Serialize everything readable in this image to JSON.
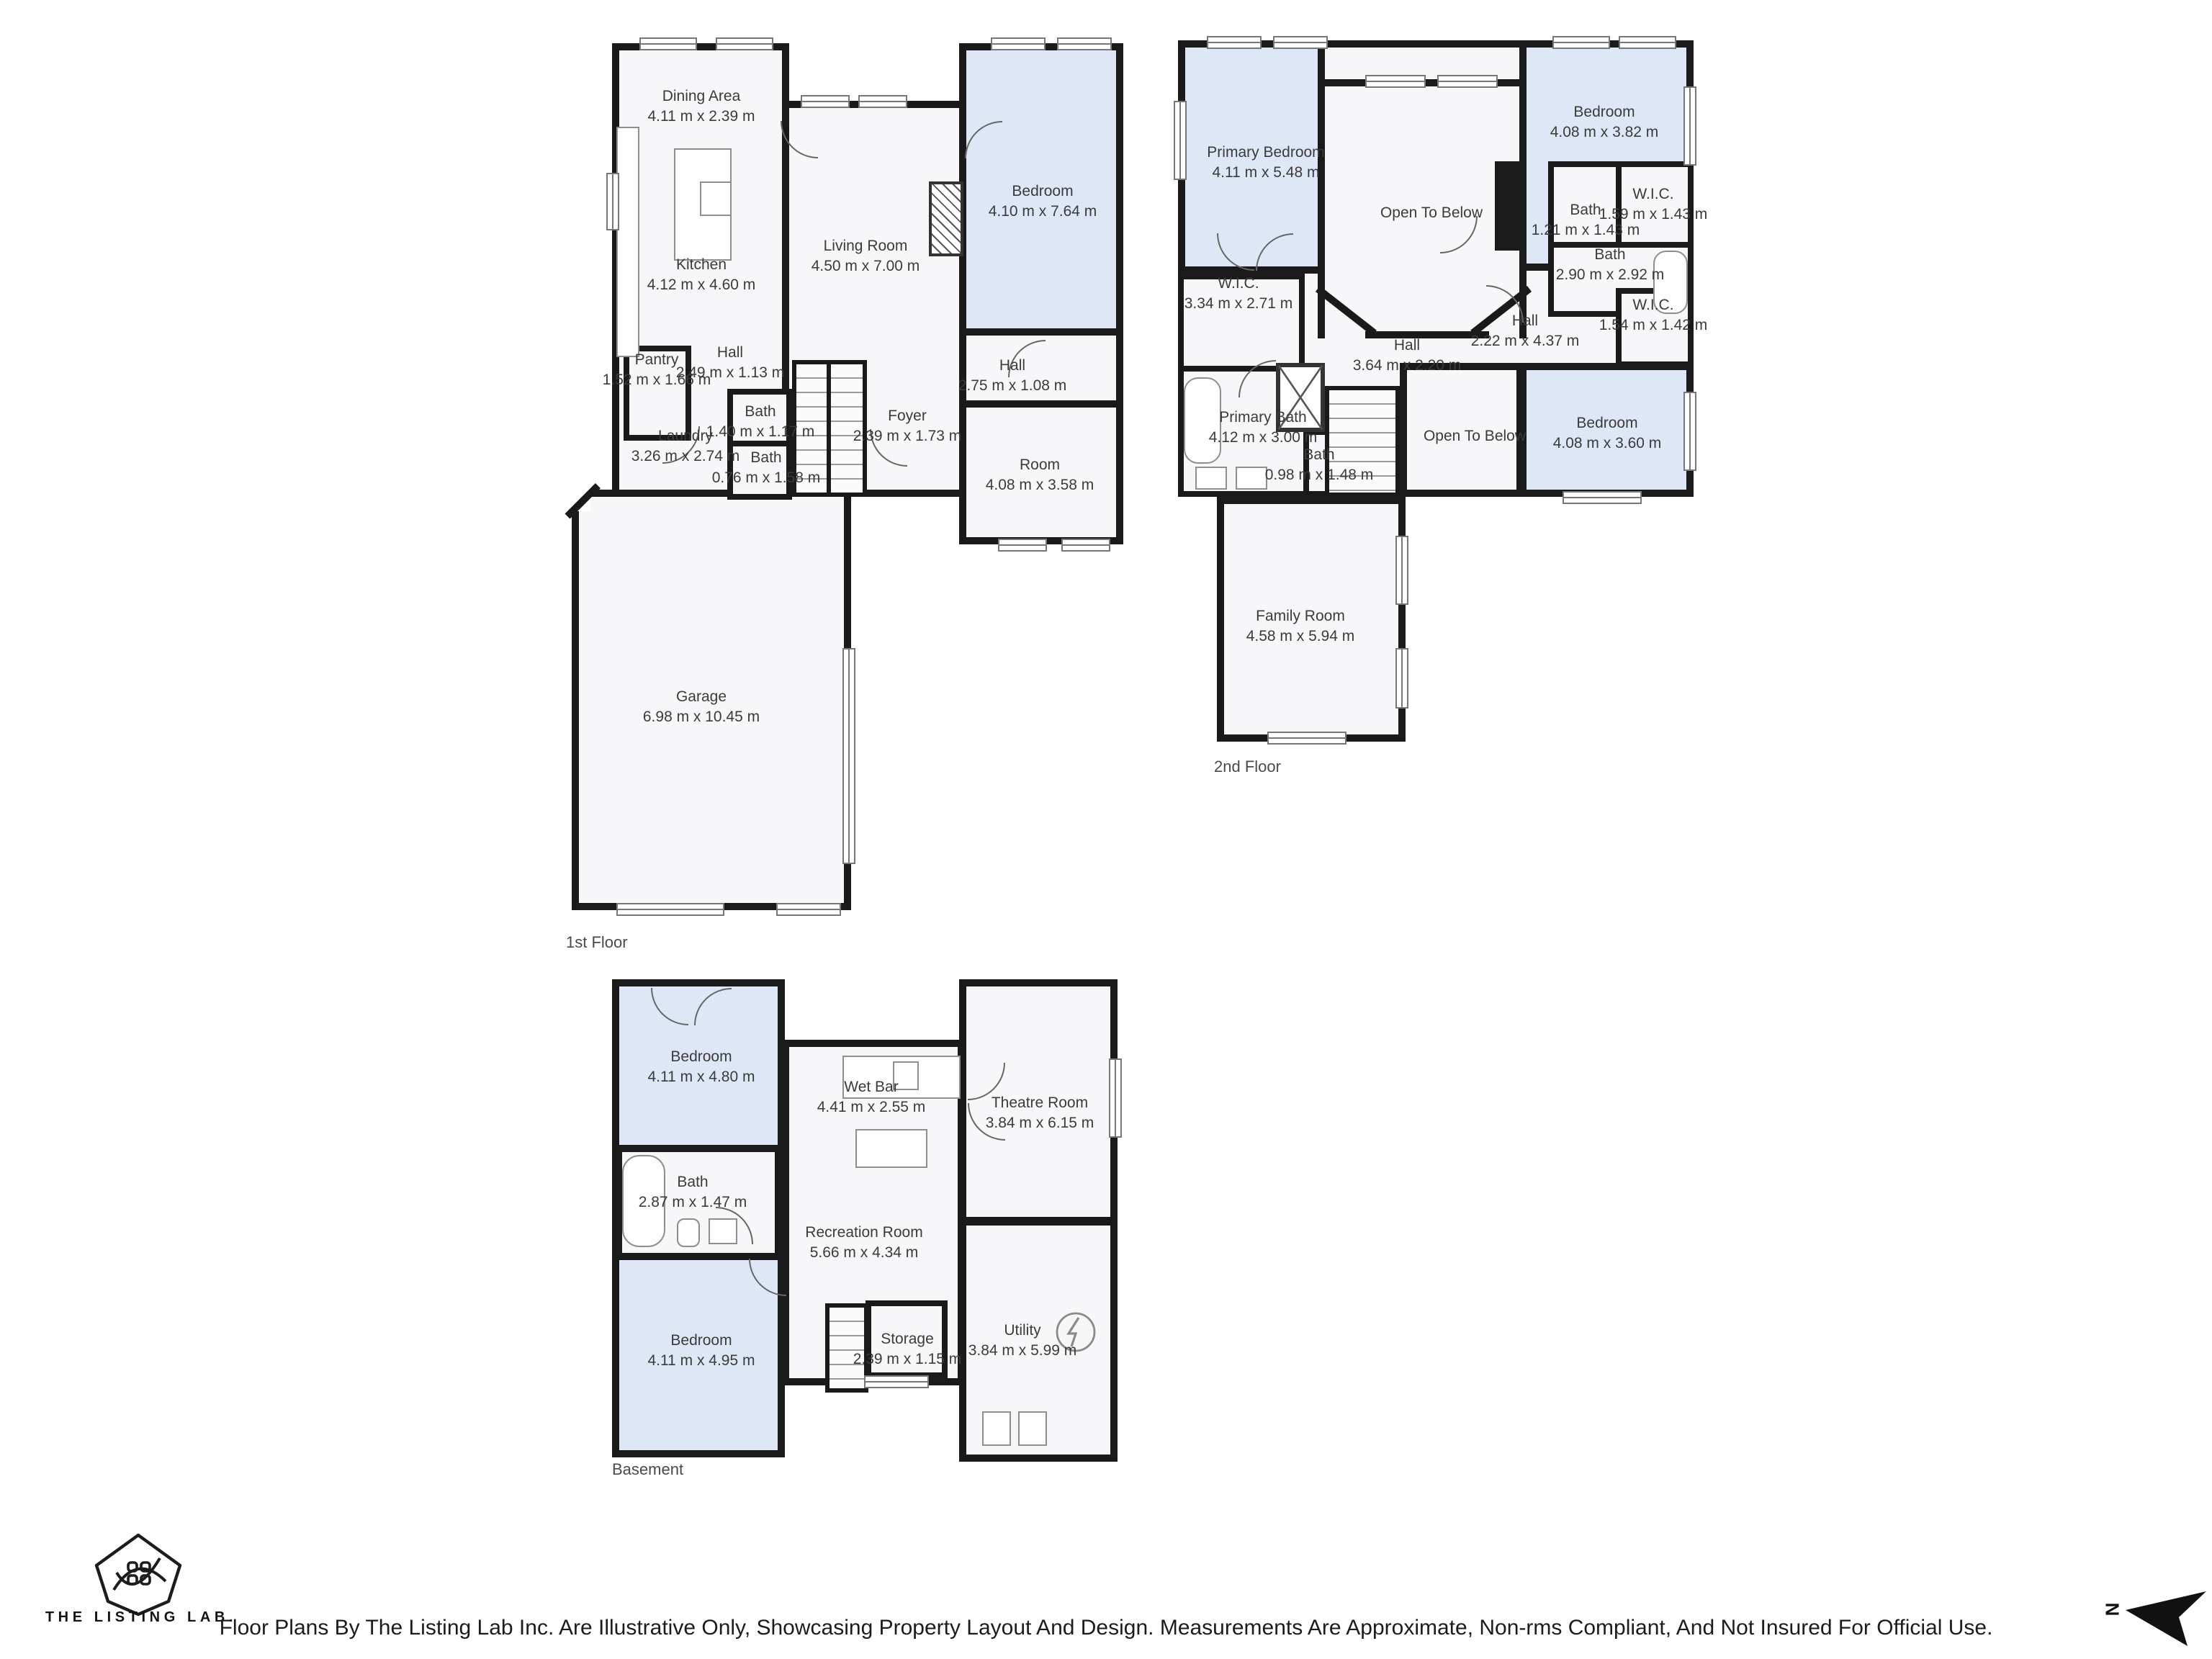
{
  "colors": {
    "wall": "#1a1a1a",
    "room_fill": "#f7f7f9",
    "bedroom_fill": "#dee7f6",
    "label_text": "#3b3b3b"
  },
  "floors": [
    {
      "label": "1st Floor",
      "rooms": [
        {
          "name": "Dining Area",
          "dims": "4.11 m x 2.39 m"
        },
        {
          "name": "Kitchen",
          "dims": "4.12 m x 4.60 m"
        },
        {
          "name": "Living Room",
          "dims": "4.50 m x 7.00 m"
        },
        {
          "name": "Bedroom",
          "dims": "4.10 m x 7.64 m"
        },
        {
          "name": "Pantry",
          "dims": "1.52 m x 1.66 m"
        },
        {
          "name": "Hall",
          "dims": "2.49 m x 1.13 m"
        },
        {
          "name": "Bath",
          "dims": "1.40 m x 1.17 m"
        },
        {
          "name": "Laundry",
          "dims": "3.26 m x 2.74 m"
        },
        {
          "name": "Bath",
          "dims": "0.76 m x 1.58 m"
        },
        {
          "name": "Foyer",
          "dims": "2.39 m x 1.73 m"
        },
        {
          "name": "Hall",
          "dims": "2.75 m x 1.08 m"
        },
        {
          "name": "Room",
          "dims": "4.08 m x 3.58 m"
        },
        {
          "name": "Garage",
          "dims": "6.98 m x 10.45 m"
        }
      ]
    },
    {
      "label": "2nd Floor",
      "rooms": [
        {
          "name": "Primary Bedroom",
          "dims": "4.11 m x 5.48 m"
        },
        {
          "name": "Open To Below",
          "dims": ""
        },
        {
          "name": "Bedroom",
          "dims": "4.08 m x 3.82 m"
        },
        {
          "name": "Bath",
          "dims": "1.21 m x 1.43 m"
        },
        {
          "name": "W.I.C.",
          "dims": "1.59 m x 1.43 m"
        },
        {
          "name": "Bath",
          "dims": "2.90 m x 2.92 m"
        },
        {
          "name": "W.I.C.",
          "dims": "3.34 m x 2.71 m"
        },
        {
          "name": "Hall",
          "dims": "2.22 m x 4.37 m"
        },
        {
          "name": "Hall",
          "dims": "3.64 m x 2.20 m"
        },
        {
          "name": "W.I.C.",
          "dims": "1.54 m x 1.42 m"
        },
        {
          "name": "Primary Bath",
          "dims": "4.12 m x 3.00 m"
        },
        {
          "name": "Bath",
          "dims": "0.98 m x 1.48 m"
        },
        {
          "name": "Open To Below",
          "dims": ""
        },
        {
          "name": "Bedroom",
          "dims": "4.08 m x 3.60 m"
        },
        {
          "name": "Family Room",
          "dims": "4.58 m x 5.94 m"
        }
      ]
    },
    {
      "label": "Basement",
      "rooms": [
        {
          "name": "Bedroom",
          "dims": "4.11 m x 4.80 m"
        },
        {
          "name": "Wet Bar",
          "dims": "4.41 m x 2.55 m"
        },
        {
          "name": "Theatre Room",
          "dims": "3.84 m x 6.15 m"
        },
        {
          "name": "Bath",
          "dims": "2.87 m x 1.47 m"
        },
        {
          "name": "Recreation Room",
          "dims": "5.66 m x 4.34 m"
        },
        {
          "name": "Bedroom",
          "dims": "4.11 m x 4.95 m"
        },
        {
          "name": "Storage",
          "dims": "2.39 m x 1.15 m"
        },
        {
          "name": "Utility",
          "dims": "3.84 m x 5.99 m"
        }
      ]
    }
  ],
  "footer": {
    "brand": "THE LISTING LAB.",
    "disclaimer": "Floor Plans By The Listing Lab Inc. Are Illustrative Only, Showcasing Property Layout And Design. Measurements Are Approximate, Non-rms Compliant, And Not Insured For Official Use.",
    "north_label": "N"
  }
}
